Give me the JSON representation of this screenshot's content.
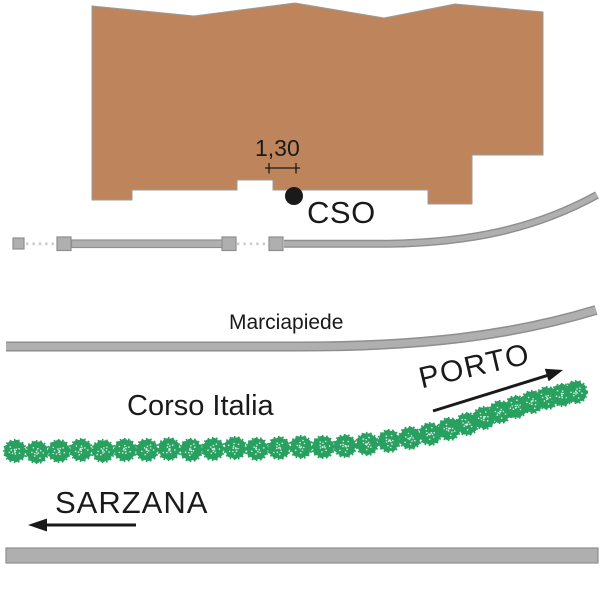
{
  "labels": {
    "dimension": "1,30",
    "point": "CSO",
    "sidewalk": "Marciapiede",
    "street": "Corso Italia",
    "direction_porto": "PORTO",
    "direction_sarzana": "SARZANA"
  },
  "colors": {
    "building_fill": "#BE855C",
    "building_outline": "#9B9B9B",
    "road_fill": "#AFAFAF",
    "road_border": "#8E8E8E",
    "dotted_line": "#CCCCCC",
    "tree_green": "#28A05F",
    "ink": "#1A1A1A"
  },
  "trees": {
    "count": 29,
    "positions": [
      [
        15,
        451
      ],
      [
        37,
        452
      ],
      [
        59,
        451
      ],
      [
        81,
        450
      ],
      [
        103,
        451
      ],
      [
        125,
        450
      ],
      [
        147,
        450
      ],
      [
        169,
        449
      ],
      [
        191,
        450
      ],
      [
        213,
        449
      ],
      [
        235,
        448
      ],
      [
        257,
        449
      ],
      [
        279,
        448
      ],
      [
        301,
        447
      ],
      [
        323,
        447
      ],
      [
        345,
        446
      ],
      [
        367,
        444
      ],
      [
        389,
        441
      ],
      [
        410,
        438
      ],
      [
        430,
        434
      ],
      [
        449,
        429
      ],
      [
        467,
        424
      ],
      [
        484,
        418
      ],
      [
        500,
        412
      ],
      [
        516,
        407
      ],
      [
        532,
        402
      ],
      [
        547,
        398
      ],
      [
        562,
        395
      ],
      [
        576,
        392
      ]
    ]
  },
  "fence": {
    "posts": [
      {
        "x": 13,
        "y": 238,
        "w": 11,
        "h": 11
      },
      {
        "x": 57,
        "y": 237,
        "w": 14,
        "h": 13.5
      },
      {
        "x": 222,
        "y": 237,
        "w": 14,
        "h": 13.5
      },
      {
        "x": 269,
        "y": 237,
        "w": 14,
        "h": 13.5
      }
    ]
  },
  "icons": {
    "porto_arrow": "arrow-up-right-icon",
    "sarzana_arrow": "arrow-left-icon"
  }
}
